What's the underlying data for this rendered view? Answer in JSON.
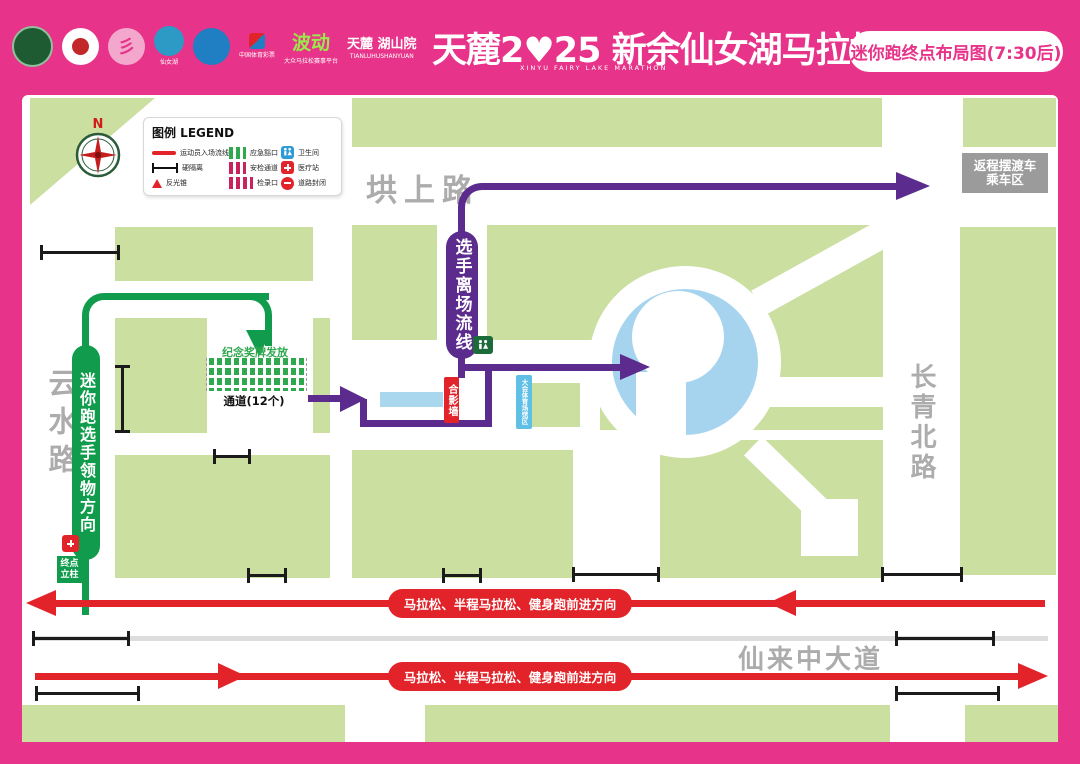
{
  "header": {
    "title": "天麓2♥25 新余仙女湖马拉松",
    "title_sub": "XINYU FAIRY LAKE MARATHON",
    "badge": "迷你跑终点布局图(7:30后)",
    "logos": [
      {
        "label": ""
      },
      {
        "label": ""
      },
      {
        "label": ""
      },
      {
        "label": "仙女湖"
      },
      {
        "label": ""
      },
      {
        "label": "中国体育彩票"
      },
      {
        "label": "波动",
        "sub": "大众马拉松赛事平台"
      },
      {
        "label": "天麓 湖山院",
        "sub": "TIANLUHUSHANYUAN"
      }
    ]
  },
  "legend": {
    "title": "图例 LEGEND",
    "items": [
      "运动员入场流线",
      "硬隔离",
      "反光锥",
      "应急豁口",
      "安检通道",
      "检录口",
      "卫生间",
      "医疗站",
      "道路封闭"
    ]
  },
  "compass": {
    "north": "N"
  },
  "roads": {
    "top": "垬上路",
    "left": "云水路",
    "right": "长青北路",
    "bottom": "仙来中大道"
  },
  "routes": {
    "exit_flow": "选手离场流线",
    "pickup": "迷你跑选手领物方向",
    "forward": "马拉松、半程马拉松、健身跑前进方向"
  },
  "labels": {
    "shuttle_line1": "返程摆渡车",
    "shuttle_line2": "乘车区",
    "medal_area": "纪念奖牌发放",
    "channels": "通道(12个)",
    "photo_wall": "合影墙",
    "stand": "大会体育场馆区",
    "finish_pillar_line1": "终点",
    "finish_pillar_line2": "立柱"
  },
  "icons": {
    "toilet": "restroom-icon",
    "medical": "medical-cross-icon",
    "road_closed": "no-entry-icon",
    "cone": "traffic-cone-icon",
    "hard_barrier": "h-barrier-icon",
    "compass": "compass-rose-icon"
  },
  "colors": {
    "frame_pink": "#E73389",
    "lawn_green": "#CBDFA1",
    "route_purple": "#5B2B8D",
    "route_green": "#119C4D",
    "route_red": "#E2242A",
    "pond_blue": "#A6D4EE",
    "stand_label_blue": "#5FBFE4",
    "road_text_gray": "#ACACAC",
    "shuttle_box_gray": "#9B9B9B"
  }
}
